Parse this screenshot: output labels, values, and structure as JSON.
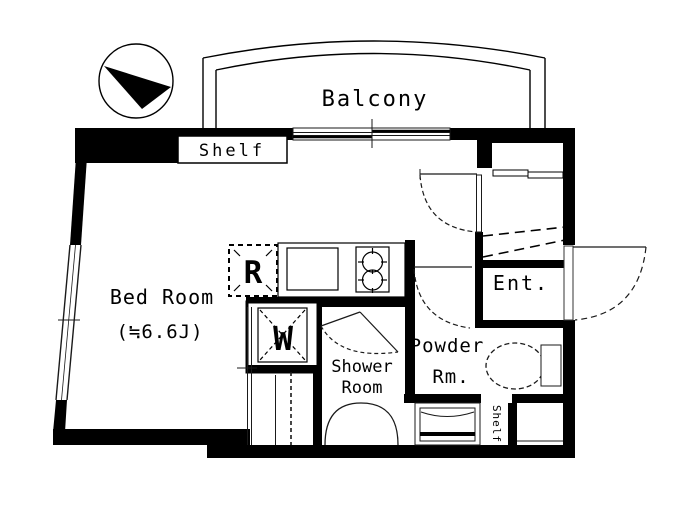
{
  "floorplan": {
    "balcony": {
      "label": "Balcony"
    },
    "shelf_top": {
      "label": "Shelf"
    },
    "shelf_side": {
      "label": "Shelf"
    },
    "bedroom": {
      "name": "Bed Room",
      "size": "(≒6.6J)"
    },
    "shower_room": {
      "line1": "Shower",
      "line2": "Room"
    },
    "powder_room": {
      "line1": "Powder",
      "line2": "Rm."
    },
    "entrance": {
      "label": "Ent."
    },
    "appliances": {
      "refrigerator": "R",
      "washer": "W"
    },
    "colors": {
      "wall": "#000000",
      "background": "#ffffff",
      "thin_line": "#1a1a1a"
    }
  }
}
